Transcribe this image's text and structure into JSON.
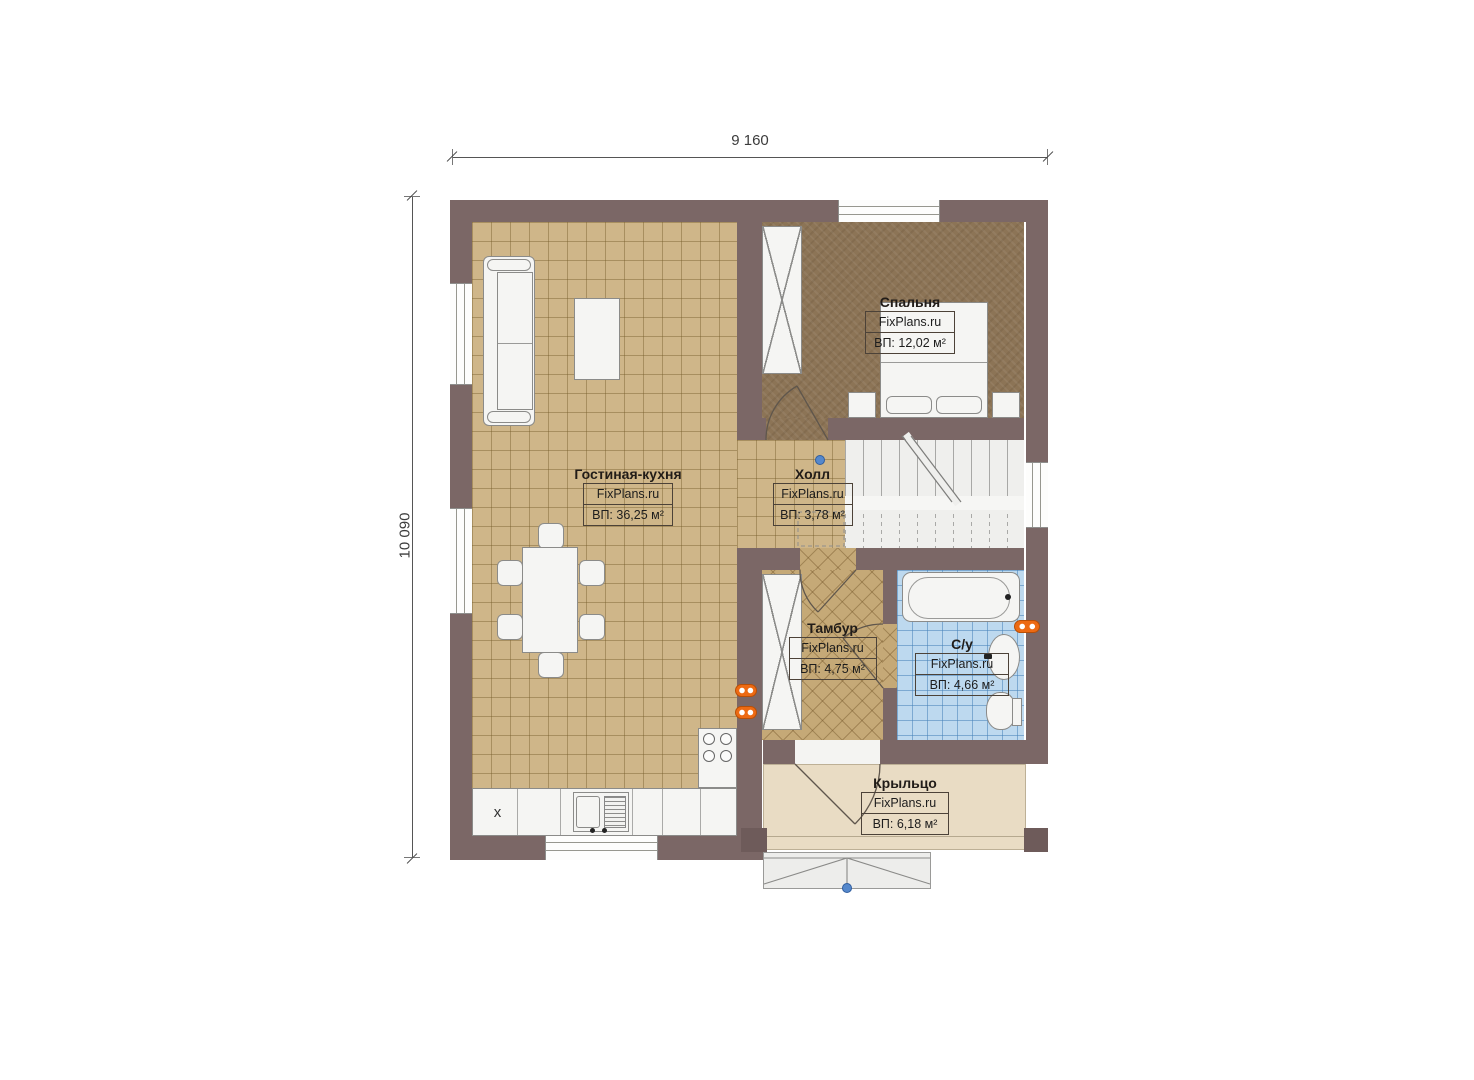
{
  "plan": {
    "dimensions": {
      "width_label": "9 160",
      "height_label": "10 090"
    },
    "rooms": [
      {
        "key": "living",
        "name": "Гостиная-кухня",
        "brand": "FixPlans.ru",
        "area": "ВП: 36,25 м²"
      },
      {
        "key": "bedroom",
        "name": "Спальня",
        "brand": "FixPlans.ru",
        "area": "ВП: 12,02 м²"
      },
      {
        "key": "hall",
        "name": "Холл",
        "brand": "FixPlans.ru",
        "area": "ВП: 3,78 м²"
      },
      {
        "key": "tambour",
        "name": "Тамбур",
        "brand": "FixPlans.ru",
        "area": "ВП: 4,75 м²"
      },
      {
        "key": "bathroom",
        "name": "С/у",
        "brand": "FixPlans.ru",
        "area": "ВП: 4,66 м²"
      },
      {
        "key": "porch",
        "name": "Крыльцо",
        "brand": "FixPlans.ru",
        "area": "ВП: 6,18 м²"
      }
    ],
    "symbols": {
      "fridge_marker": "x"
    },
    "colors": {
      "wall": "#7b6766",
      "floor_tile": "#cfb689",
      "floor_bedroom": "#8c7456",
      "floor_bath": "#bdd9ef",
      "floor_porch": "#e9dcc4",
      "radiator": "#ed6a13",
      "marker_blue": "#5588cc"
    }
  }
}
